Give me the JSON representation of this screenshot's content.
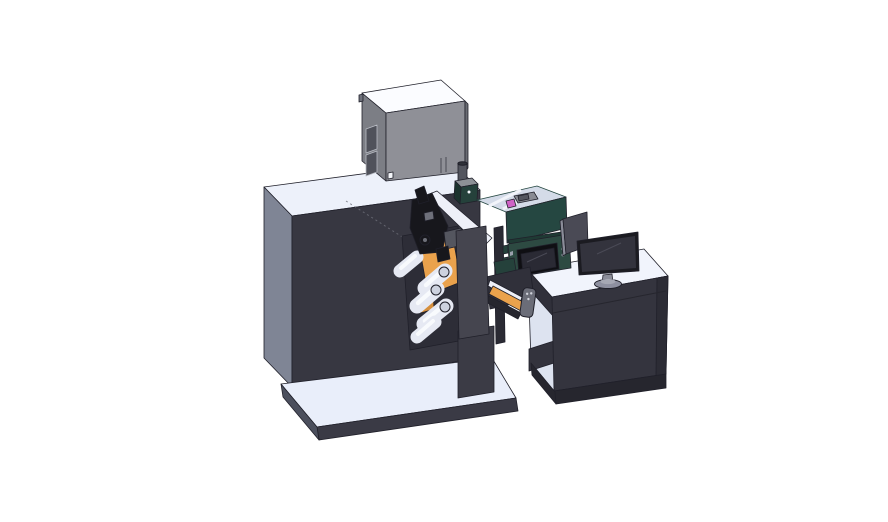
{
  "meta": {
    "description": "3D CAD render of a roll-fed label printing machine with web rollers, print head, protective enclosure and HMI panel, beside an operator desk with a monitor, on a white background."
  },
  "parts": [
    "machine-cabinet",
    "base-platform",
    "electrical-box",
    "box-cylinder",
    "web-rollers",
    "orange-web-guides",
    "print-head",
    "media-guide-slab",
    "front-cover-plate",
    "support-column",
    "protective-enclosure",
    "hmi-touch-panel",
    "output-chute",
    "pendant-remote",
    "operator-desk",
    "desk-monitor",
    "side-screen"
  ],
  "colors": {
    "background": "#ffffff",
    "edge": "#20202a",
    "machine_top": "#edf1fa",
    "machine_left": "#7f8595",
    "machine_front": "#373741",
    "base_top": "#e9eefa",
    "base_skirt": "#3a3a45",
    "base_side": "#4b4f5d",
    "box_top": "#fbfcff",
    "box_front": "#8f9097",
    "box_side": "#7c7e85",
    "box_right": "#6a6c73",
    "box_window": "#50525b",
    "box_window_frame": "#b9bcc4",
    "box_sticker": "#f4f6fa",
    "cylinder": "#53555e",
    "cylinder_cap": "#2f3139",
    "cylinder_flange": "#484a53",
    "mech_backdrop": "#2d2d37",
    "orange": "#eaa24c",
    "orange_dark": "#d68f3d",
    "roller": "#e6e9f3",
    "roller_highlight": "#f8fafd",
    "roller_cap": "#cdd2df",
    "slab": "#eef0f8",
    "black_part": "#17171c",
    "gray_part": "#6e707a",
    "bracket": "#54565f",
    "plate": "#45454f",
    "green_box_top": "#8d9196",
    "green_box_front": "#25413b",
    "green_box_side": "#1c332e",
    "glass": "#cdd5e4",
    "enclosure_frame": "#254741",
    "strut": "#f2f4fa",
    "pink": "#cf63c6",
    "block_gray": "#898b93",
    "leg": "#2a2a33",
    "column": "#3b3b45",
    "hmi_green": "#2d4a42",
    "hmi_top": "#1f3a34",
    "screen_bezel": "#0f0f13",
    "screen_face": "#2a2a34",
    "button": "#9aa0ac",
    "chute_frame": "#30303a",
    "chute_white": "#eef0f8",
    "chute_under": "#26262e",
    "remote": "#6b6d78",
    "remote_dot": "#cfd2da",
    "desk_top": "#f1f4fc",
    "desk_front": "#34343e",
    "desk_edge": "#2c2c35",
    "desk_interior": "#dde3f0",
    "desk_band": "#30303a",
    "desk_shelf": "#33333d",
    "plinth": "#26262e",
    "panel2": "#4a4a55",
    "panel2_edge": "#8a8c98",
    "monitor_bezel": "#1b1b21",
    "monitor_screen": "#33333d",
    "monitor_line": "#4a4a56",
    "stand": "#8b8d99",
    "base_oval": "#8e90a0",
    "base_oval_top": "#a6a8b4"
  }
}
